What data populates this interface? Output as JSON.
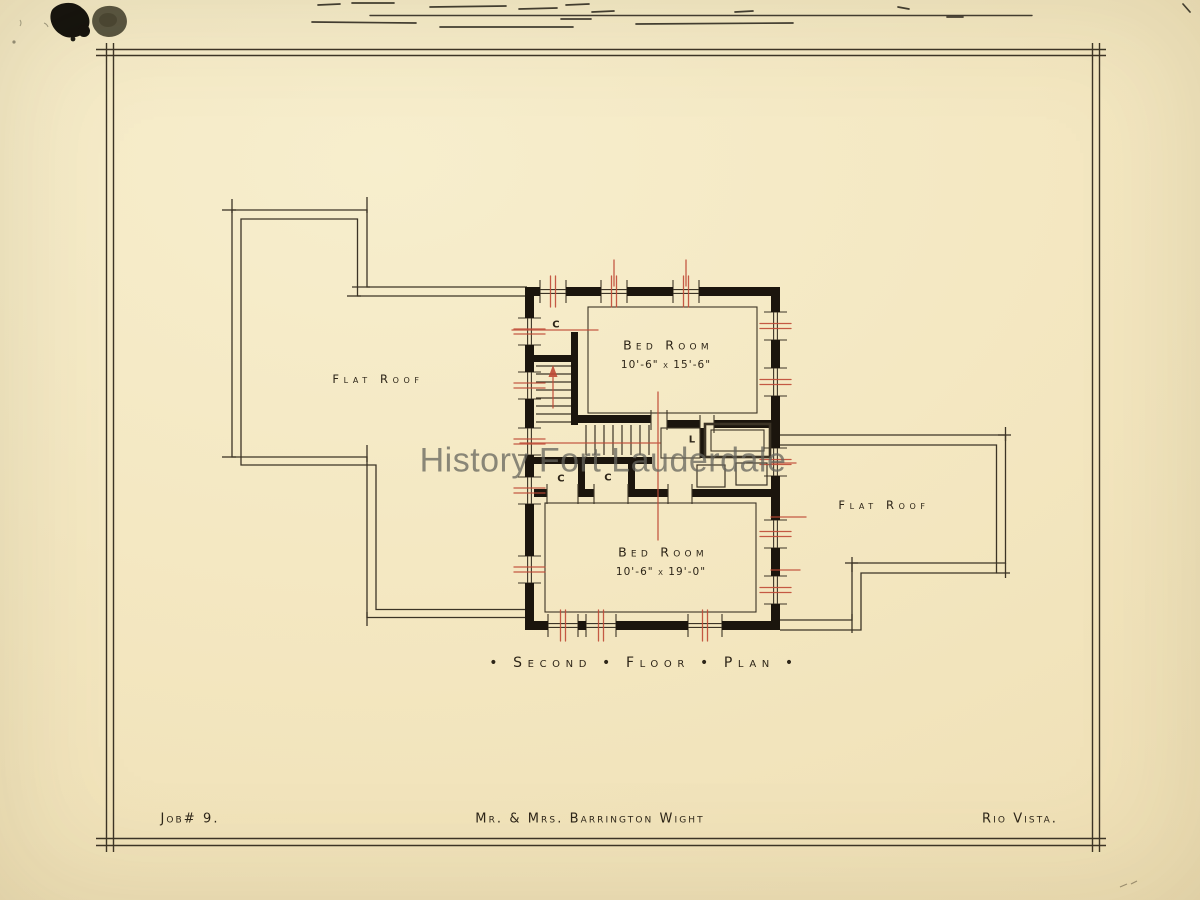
{
  "watermark": "History Fort Lauderdale",
  "plan": {
    "roof_label_left": "Flat Roof",
    "roof_label_right": "Flat Roof",
    "rooms": [
      {
        "name": "Bed Room",
        "dimensions": "10'-6\" x 15'-6\""
      },
      {
        "name": "Bed Room",
        "dimensions": "10'-6\" x 19'-0\""
      }
    ],
    "closet_labels": [
      "C",
      "C",
      "C"
    ],
    "linen_label": "L",
    "title": "• Second • Floor • Plan •"
  },
  "title_block": {
    "job_number": "Job# 9.",
    "client": "Mr. & Mrs. Barrington Wight",
    "location": "Rio Vista."
  },
  "colors": {
    "paper": "#f3e6bf",
    "ink_wall": "#1b150d",
    "ink_line": "#3c3426",
    "ink_text": "#2d2518",
    "red_pencil": "#bf4a36",
    "watermark_gray": "#66655d"
  }
}
